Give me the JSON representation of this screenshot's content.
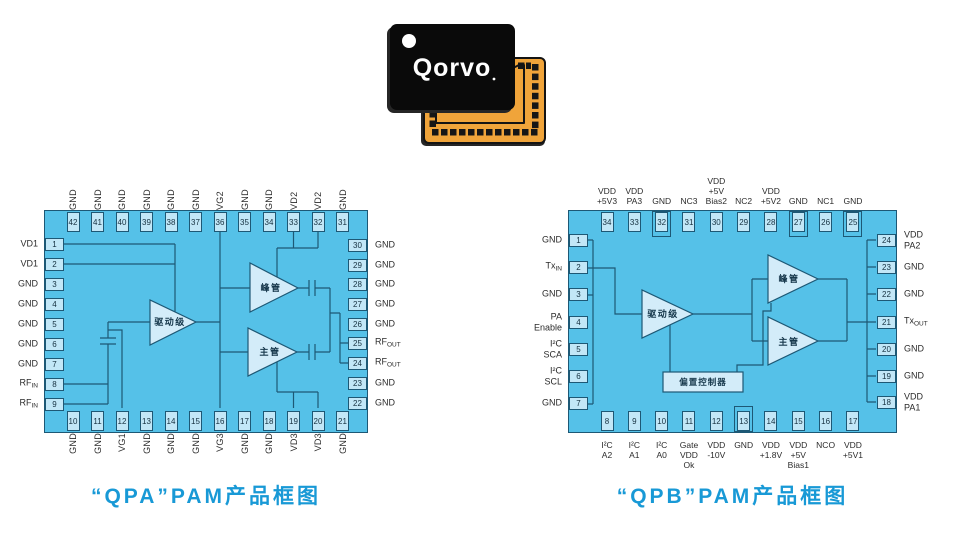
{
  "chip_photo": {
    "logo_text": "Qorvo"
  },
  "colors": {
    "chip_fill": "#55c1e8",
    "pin_fill": "#c2e7f7",
    "outline": "#1d5875",
    "caption_blue": "#1899d6",
    "package_black": "#0a0a0a",
    "package_orange": "#f0a43a"
  },
  "diagrams": [
    {
      "id": "qpa",
      "caption": "“QPA”PAM产品框图",
      "blocks": {
        "driver": "驱动级",
        "peak": "峰管",
        "main": "主管"
      },
      "pins": {
        "top": [
          {
            "n": "42",
            "label": "GND"
          },
          {
            "n": "41",
            "label": "GND"
          },
          {
            "n": "40",
            "label": "GND"
          },
          {
            "n": "39",
            "label": "GND"
          },
          {
            "n": "38",
            "label": "GND"
          },
          {
            "n": "37",
            "label": "GND"
          },
          {
            "n": "36",
            "label": "VG2"
          },
          {
            "n": "35",
            "label": "GND"
          },
          {
            "n": "34",
            "label": "GND"
          },
          {
            "n": "33",
            "label": "VD2"
          },
          {
            "n": "32",
            "label": "VD2"
          },
          {
            "n": "31",
            "label": "GND"
          }
        ],
        "left": [
          {
            "n": "1",
            "label": "VD1"
          },
          {
            "n": "2",
            "label": "VD1"
          },
          {
            "n": "3",
            "label": "GND"
          },
          {
            "n": "4",
            "label": "GND"
          },
          {
            "n": "5",
            "label": "GND"
          },
          {
            "n": "6",
            "label": "GND"
          },
          {
            "n": "7",
            "label": "GND"
          },
          {
            "n": "8",
            "label": "RF_IN"
          },
          {
            "n": "9",
            "label": "RF_IN"
          }
        ],
        "right": [
          {
            "n": "30",
            "label": "GND"
          },
          {
            "n": "29",
            "label": "GND"
          },
          {
            "n": "28",
            "label": "GND"
          },
          {
            "n": "27",
            "label": "GND"
          },
          {
            "n": "26",
            "label": "GND"
          },
          {
            "n": "25",
            "label": "RF_OUT"
          },
          {
            "n": "24",
            "label": "RF_OUT"
          },
          {
            "n": "23",
            "label": "GND"
          },
          {
            "n": "22",
            "label": "GND"
          }
        ],
        "bottom": [
          {
            "n": "10",
            "label": "GND"
          },
          {
            "n": "11",
            "label": "GND"
          },
          {
            "n": "12",
            "label": "VG1"
          },
          {
            "n": "13",
            "label": "GND"
          },
          {
            "n": "14",
            "label": "GND"
          },
          {
            "n": "15",
            "label": "GND"
          },
          {
            "n": "16",
            "label": "VG3"
          },
          {
            "n": "17",
            "label": "GND"
          },
          {
            "n": "18",
            "label": "GND"
          },
          {
            "n": "19",
            "label": "VD3"
          },
          {
            "n": "20",
            "label": "VD3"
          },
          {
            "n": "21",
            "label": "GND"
          }
        ]
      }
    },
    {
      "id": "qpb",
      "caption": "“QPB”PAM产品框图",
      "blocks": {
        "driver": "驱动级",
        "peak": "峰管",
        "main": "主管",
        "bias": "偏置控制器"
      },
      "pins": {
        "top": [
          {
            "n": "34",
            "label": "VDD\n+5V3"
          },
          {
            "n": "33",
            "label": "VDD\nPA3"
          },
          {
            "n": "32",
            "label": "GND"
          },
          {
            "n": "31",
            "label": "NC3"
          },
          {
            "n": "30",
            "label": "VDD\n+5V\nBias2"
          },
          {
            "n": "29",
            "label": "NC2"
          },
          {
            "n": "28",
            "label": "VDD\n+5V2"
          },
          {
            "n": "27",
            "label": "GND"
          },
          {
            "n": "26",
            "label": "NC1"
          },
          {
            "n": "25",
            "label": "GND"
          }
        ],
        "left": [
          {
            "n": "1",
            "label": "GND"
          },
          {
            "n": "2",
            "label": "Tx_IN"
          },
          {
            "n": "3",
            "label": "GND"
          },
          {
            "n": "4",
            "label": "PA\nEnable"
          },
          {
            "n": "5",
            "label": "I²C\nSCA"
          },
          {
            "n": "6",
            "label": "I²C\nSCL"
          },
          {
            "n": "7",
            "label": "GND"
          }
        ],
        "right": [
          {
            "n": "24",
            "label": "VDD\nPA2"
          },
          {
            "n": "23",
            "label": "GND"
          },
          {
            "n": "22",
            "label": "GND"
          },
          {
            "n": "21",
            "label": "Tx_OUT"
          },
          {
            "n": "20",
            "label": "GND"
          },
          {
            "n": "19",
            "label": "GND"
          },
          {
            "n": "18",
            "label": "VDD\nPA1"
          }
        ],
        "bottom": [
          {
            "n": "8",
            "label": "I²C\nA2"
          },
          {
            "n": "9",
            "label": "I²C\nA1"
          },
          {
            "n": "10",
            "label": "I²C\nA0"
          },
          {
            "n": "11",
            "label": "Gate\nVDD\nOk"
          },
          {
            "n": "12",
            "label": "VDD\n-10V"
          },
          {
            "n": "13",
            "label": "GND"
          },
          {
            "n": "14",
            "label": "VDD\n+1.8V"
          },
          {
            "n": "15",
            "label": "VDD\n+5V\nBias1"
          },
          {
            "n": "16",
            "label": "NCO"
          },
          {
            "n": "17",
            "label": "VDD\n+5V1"
          }
        ]
      }
    }
  ]
}
